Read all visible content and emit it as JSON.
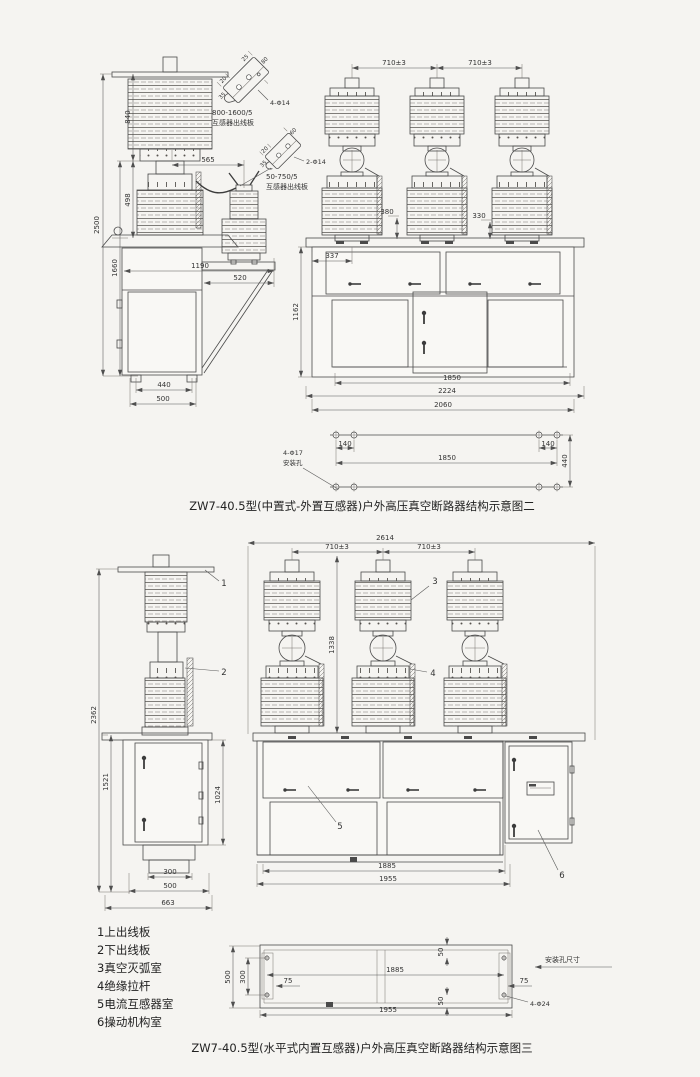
{
  "palette": {
    "line": "#4a4a4a",
    "text": "#333333",
    "background": "#f5f4f1"
  },
  "captions": {
    "fig2": "ZW7-40.5型(中置式-外置互感器)户外高压真空断路器结构示意图二",
    "fig3": "ZW7-40.5型(水平式内置互感器)户外高压真空断路器结构示意图三"
  },
  "legend": {
    "i1": "1上出线板",
    "i2": "2下出线板",
    "i3": "3真空灭弧室",
    "i4": "4绝缘拉杆",
    "i5": "5电流互感器室",
    "i6": "6操动机构室"
  },
  "fig2": {
    "bracket_large": {
      "rating": "800-1600/5",
      "name": "互感器出线板",
      "holes": "4-Φ14",
      "dim_a": "20",
      "dim_b": "35",
      "dim_c": "25",
      "dim_d": "80"
    },
    "bracket_small": {
      "rating": "50-750/5",
      "name": "互感器出线板",
      "holes": "2-Φ14",
      "dim_a": "20",
      "dim_b": "35",
      "dim_c": "60"
    },
    "side": {
      "d840": "840",
      "d2500": "2500",
      "d498": "498",
      "d1660": "1660",
      "d565": "565",
      "d1190": "1190",
      "d520": "520",
      "d440": "440",
      "d500": "500"
    },
    "front": {
      "pitch_left": "710±3",
      "pitch_right": "710±3",
      "d380": "380",
      "d330": "330",
      "d337": "337",
      "d1162": "1162",
      "d1850": "1850",
      "d2224": "2224",
      "d2060": "2060"
    },
    "mount": {
      "d140_left": "140",
      "d140_right": "140",
      "d1850": "1850",
      "d_depth": "440",
      "holes": "4-Φ17",
      "holes_label": "安装孔"
    }
  },
  "fig3": {
    "side": {
      "d2362": "2362",
      "d1521": "1521",
      "d1024": "1024",
      "d300": "300",
      "d500": "500",
      "d663": "663"
    },
    "front": {
      "d2614": "2614",
      "pitch_left": "710±3",
      "pitch_right": "710±3",
      "d1338": "1338",
      "d1885": "1885",
      "d1955": "1955"
    },
    "callouts": {
      "c1": "1",
      "c2": "2",
      "c3": "3",
      "c4": "4",
      "c5": "5",
      "c6": "6"
    },
    "mount": {
      "d500": "500",
      "d300": "300",
      "d75_left": "75",
      "d1885": "1885",
      "d50_top": "50",
      "d50_bottom": "50",
      "d75_right": "75",
      "d1955": "1955",
      "holes": "4-Φ24",
      "title": "安装孔尺寸"
    }
  }
}
